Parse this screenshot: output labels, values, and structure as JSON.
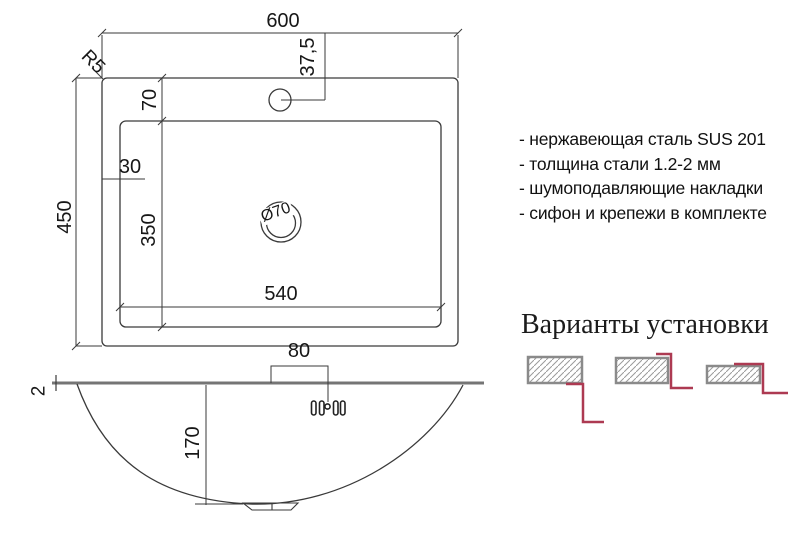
{
  "top_view": {
    "dim_width": "600",
    "dim_height": "450",
    "dim_rear_deck": "70",
    "dim_side_deck": "30",
    "dim_bowl_depth_front": "350",
    "dim_bowl_width": "540",
    "dim_faucet_offset": "37,5",
    "corner_radius_label": "R5",
    "drain_label": "Ø70"
  },
  "side_view": {
    "dim_overflow_offset": "80",
    "dim_bowl_depth": "170",
    "dim_steel_thickness": "2"
  },
  "specs": {
    "items": [
      "- нержавеющая сталь SUS 201",
      "- толщина стали 1.2-2 мм",
      "- шумоподавляющие накладки",
      "- сифон и крепежи в комплекте"
    ]
  },
  "installation": {
    "title": "Варианты установки"
  },
  "colors": {
    "line": "#3a3a3a",
    "deck_gray": "#757575",
    "accent_red": "#ad3a52",
    "hatch_fill": "#e9e9e9",
    "hatch_border": "#8a8a8a"
  }
}
